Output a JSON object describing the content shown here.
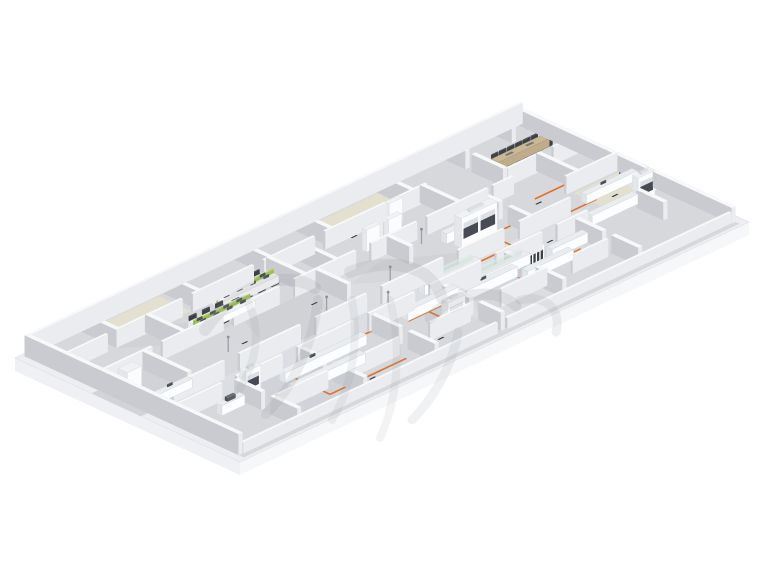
{
  "scene": {
    "kind": "isometric-3d-floorplan-render",
    "subject": "laboratory-and-office-floor",
    "background": "#ffffff",
    "watermark_present": true
  },
  "palette": {
    "slab_top": "#eceef1",
    "slab_edge": "#e0e2e6",
    "skirt_left": "#eff0f3",
    "skirt_front": "#f6f7f9",
    "floor": "#d7d8dc",
    "floor_light": "#dcdde1",
    "floor_dark": "#d1d3d8",
    "corridor": "#dddee3",
    "beige": "#e3e0d0",
    "wall_top": "#f7f8fa",
    "wall_light": "#eaecef",
    "wall_dark": "#c9cbd0",
    "furn_top": "#eaedef",
    "furn_light": "#fcfdfe",
    "furn_dark": "#e0e3e7",
    "accent_orange": "#e0702b",
    "partition_green": "#9dc14d",
    "partition_green_dark": "#86ab3b",
    "partition_green_top": "#b3d06a",
    "wood_top": "#c9b795",
    "wood_light": "#bfac8a",
    "wood_dark": "#ab997a",
    "chair_dark": "#33363b",
    "sash_dark": "#474c54",
    "glass_tint": "#b0c6bc",
    "screen_blue": "#8499ad",
    "mark_dark": "#2f3237",
    "watermark": "#8e9298"
  },
  "iso": {
    "origin": [
      15,
      358
    ],
    "e1": [
      5.09,
      -2.4
    ],
    "e2": [
      2.25,
      1.04
    ],
    "skirt_depth": 13,
    "floor_inset": 1.3
  },
  "floors": {
    "beige_patches": [
      [
        13,
        3,
        14,
        14
      ],
      [
        55,
        3,
        16,
        15
      ],
      [
        89,
        47,
        9,
        14
      ]
    ],
    "corridor": [
      2,
      56,
      84,
      10
    ],
    "tints": [
      [
        0,
        34,
        13,
        22,
        "floor_dark"
      ],
      [
        44,
        34,
        14,
        22,
        "floor_light"
      ],
      [
        13,
        66,
        13,
        30,
        "floor_dark"
      ],
      [
        53,
        66,
        13,
        31,
        "floor_light"
      ]
    ],
    "shade_sweeps": [
      [
        30,
        34,
        44,
        34,
        38,
        56,
        26,
        56
      ],
      [
        48,
        40,
        56,
        36,
        70,
        56,
        60,
        60
      ],
      [
        12,
        18,
        20,
        14,
        30,
        33,
        20,
        33
      ],
      [
        60,
        66,
        70,
        66,
        64,
        84,
        54,
        84
      ]
    ]
  },
  "walls": {
    "perimeter": [
      [
        1.3,
        1.3,
        97.4,
        1.1,
        21
      ],
      [
        1.3,
        2.4,
        0.8,
        94,
        21
      ],
      [
        97.9,
        2.4,
        0.8,
        56,
        16
      ],
      [
        97.9,
        62,
        0.8,
        35,
        16
      ],
      [
        2.1,
        95.6,
        50,
        1.1,
        11
      ],
      [
        54,
        95.6,
        44,
        1.1,
        11
      ]
    ],
    "interior": [
      [
        1.3,
        17,
        9,
        1,
        18
      ],
      [
        12,
        17,
        13,
        1,
        18
      ],
      [
        27,
        17,
        12,
        1,
        18
      ],
      [
        41,
        17,
        10,
        1,
        18
      ],
      [
        53,
        17,
        12,
        1,
        18
      ],
      [
        67,
        17,
        6,
        1,
        18
      ],
      [
        2,
        33,
        10,
        1,
        18
      ],
      [
        14,
        33,
        12,
        1,
        18
      ],
      [
        28,
        33,
        9,
        1,
        18
      ],
      [
        40,
        33,
        12,
        1,
        18
      ],
      [
        55,
        33,
        9,
        1,
        18
      ],
      [
        66,
        33,
        12,
        1,
        18
      ],
      [
        79,
        33,
        4,
        1,
        18
      ],
      [
        84,
        28,
        6,
        1,
        18
      ],
      [
        93,
        28,
        5,
        1,
        18
      ],
      [
        6,
        56,
        10,
        1,
        18
      ],
      [
        19,
        56,
        12,
        1,
        18
      ],
      [
        34,
        56,
        10,
        1,
        18
      ],
      [
        47,
        56,
        12,
        1,
        18
      ],
      [
        62,
        56,
        9,
        1,
        18
      ],
      [
        74,
        56,
        10,
        1,
        18
      ],
      [
        2.1,
        66,
        9,
        1,
        18
      ],
      [
        14,
        66,
        9,
        1,
        18
      ],
      [
        26,
        66,
        11,
        1,
        18
      ],
      [
        40,
        66,
        9,
        1,
        18
      ],
      [
        52,
        66,
        10,
        1,
        18
      ],
      [
        65,
        66,
        9,
        1,
        18
      ],
      [
        77,
        66,
        6,
        1,
        18
      ],
      [
        14,
        84,
        10,
        1,
        18
      ],
      [
        28,
        84,
        10,
        1,
        18
      ],
      [
        44,
        84,
        8,
        1,
        18
      ],
      [
        58,
        84,
        9,
        1,
        18
      ],
      [
        72,
        84,
        7,
        1,
        18
      ],
      [
        88,
        45,
        10,
        1,
        18
      ],
      [
        12,
        1.3,
        0.8,
        16,
        18
      ],
      [
        28,
        1.3,
        0.8,
        16,
        18
      ],
      [
        42,
        1.3,
        0.8,
        16,
        18
      ],
      [
        54,
        1.3,
        0.8,
        16,
        18
      ],
      [
        70,
        1.3,
        0.8,
        16,
        18
      ],
      [
        83.5,
        1.3,
        0.8,
        10,
        18
      ],
      [
        83.5,
        14,
        0.8,
        14,
        18
      ],
      [
        93.5,
        1.3,
        0.8,
        8,
        18
      ],
      [
        18,
        17,
        0.8,
        16,
        18
      ],
      [
        41.8,
        17,
        0.8,
        16,
        18
      ],
      [
        48,
        18,
        0.8,
        15,
        18
      ],
      [
        60,
        17,
        0.8,
        9,
        18
      ],
      [
        72,
        17,
        0.8,
        16,
        18
      ],
      [
        10,
        34,
        0.8,
        20,
        18
      ],
      [
        44,
        34,
        0.8,
        14,
        18
      ],
      [
        58,
        34,
        0.8,
        10,
        18
      ],
      [
        76,
        34,
        0.8,
        9,
        18
      ],
      [
        76,
        47,
        0.8,
        9,
        18
      ],
      [
        90,
        28,
        0.8,
        17,
        18
      ],
      [
        13,
        68,
        0.8,
        12,
        18
      ],
      [
        13,
        84,
        0.8,
        12,
        18
      ],
      [
        26,
        68,
        0.8,
        10,
        18
      ],
      [
        26,
        82,
        0.8,
        14,
        18
      ],
      [
        40,
        68,
        0.8,
        12,
        18
      ],
      [
        40,
        84,
        0.8,
        12,
        18
      ],
      [
        53,
        70,
        0.8,
        12,
        18
      ],
      [
        53,
        86,
        0.8,
        10,
        18
      ],
      [
        66,
        68,
        0.8,
        10,
        18
      ],
      [
        66,
        82,
        0.8,
        12,
        18
      ],
      [
        80,
        68,
        0.8,
        12,
        18
      ],
      [
        80,
        84,
        0.8,
        12,
        18
      ],
      [
        92,
        68,
        0.8,
        12,
        18
      ]
    ]
  },
  "furniture": {
    "desk_clusters": [
      {
        "s": 23,
        "t": 25,
        "desks_per_row": 4,
        "rows": 2,
        "chairs_per_side": 4
      },
      {
        "s": 30.5,
        "t": 18.4,
        "desks_per_row": 4,
        "rows": 2,
        "chairs_per_side": 4
      }
    ],
    "conference": {
      "table": [
        86.5,
        16,
        10,
        3.2,
        8
      ],
      "chairs_per_side": 6,
      "end_chairs": 2
    },
    "benches": [
      [
        21,
        70,
        16,
        2.6,
        10,
        "monitor"
      ],
      [
        19,
        78.5,
        14,
        2.6,
        10,
        ""
      ],
      [
        8,
        71.5,
        4.5,
        2.4,
        10,
        "instrument"
      ],
      [
        4.5,
        51.5,
        6.5,
        2.4,
        9,
        "monitor"
      ],
      [
        46,
        68,
        10,
        2.6,
        10,
        ""
      ],
      [
        56,
        71.5,
        10,
        2.6,
        10,
        "monitor"
      ],
      [
        66,
        76,
        9,
        2.6,
        10,
        ""
      ],
      [
        73,
        71,
        7,
        2.6,
        10,
        ""
      ],
      [
        53,
        59.5,
        11,
        2.7,
        10,
        "glass"
      ],
      [
        59,
        68,
        11,
        2.7,
        10,
        "glass"
      ],
      [
        66,
        40,
        10,
        2.6,
        10,
        ""
      ],
      [
        84,
        64,
        9,
        2.5,
        10,
        ""
      ],
      [
        88,
        52.5,
        10,
        2.4,
        9,
        "monitor"
      ],
      [
        95.6,
        54.9,
        2.3,
        9,
        9,
        ""
      ]
    ],
    "fume_hoods": [
      [
        66.5,
        44.8,
        7,
        3.2,
        30,
        2
      ],
      [
        29.5,
        69.5,
        3.4,
        2.7,
        26,
        1
      ],
      [
        48,
        81,
        3.4,
        2.8,
        27,
        1
      ],
      [
        14.2,
        67.8,
        3,
        2.6,
        25,
        1
      ],
      [
        93,
        64,
        3.3,
        2.6,
        26,
        1
      ],
      [
        3.2,
        38.5,
        2.8,
        4.2,
        22,
        0
      ]
    ],
    "tall_cabinets": [
      [
        56.5,
        26.5,
        2.6,
        2,
        22
      ],
      [
        60.8,
        26.5,
        2.6,
        2,
        22
      ],
      [
        63.8,
        20,
        2.6,
        2,
        24
      ]
    ],
    "gas_cabinets": [
      [
        68.5,
        71.5,
        3.2,
        1.5,
        17
      ]
    ],
    "safety_poles": [
      [
        22,
        45
      ],
      [
        40,
        48
      ],
      [
        52.5,
        48
      ],
      [
        63.5,
        37
      ],
      [
        47,
        59.5
      ]
    ],
    "ceiling_fixture": [
      96.3,
      51
    ],
    "wall_screen": [
      97.3,
      65.5
    ]
  },
  "utility_lines": {
    "color_key": "accent_orange",
    "paths": [
      [
        [
          23,
          69
        ],
        [
          23,
          88
        ],
        [
          38,
          88
        ]
      ],
      [
        [
          26,
          67.2
        ],
        [
          42,
          67.2
        ],
        [
          42,
          72
        ]
      ],
      [
        [
          33,
          67.2
        ],
        [
          33,
          63
        ]
      ],
      [
        [
          46,
          70.8
        ],
        [
          57,
          70.8
        ]
      ],
      [
        [
          50,
          66.4
        ],
        [
          50,
          76
        ]
      ],
      [
        [
          56,
          66.4
        ],
        [
          74,
          66.4
        ]
      ],
      [
        [
          62,
          66.4
        ],
        [
          62,
          59
        ]
      ],
      [
        [
          66,
          69.5
        ],
        [
          66,
          75
        ],
        [
          78,
          75
        ]
      ],
      [
        [
          72,
          66.4
        ],
        [
          72,
          78
        ],
        [
          80,
          78
        ]
      ],
      [
        [
          58,
          58.5
        ],
        [
          72,
          58.5
        ],
        [
          72,
          52
        ]
      ],
      [
        [
          66,
          48.3
        ],
        [
          84,
          48.3
        ]
      ],
      [
        [
          70,
          48.3
        ],
        [
          70,
          44
        ]
      ],
      [
        [
          80,
          48.3
        ],
        [
          80,
          55
        ],
        [
          90,
          55
        ]
      ],
      [
        [
          84,
          41
        ],
        [
          93,
          41
        ]
      ],
      [
        [
          2.5,
          40
        ],
        [
          2.5,
          48
        ]
      ]
    ]
  },
  "floor_marks": [
    [
      20,
      64.3
    ],
    [
      34,
      64.3
    ],
    [
      49,
      64.3
    ],
    [
      63,
      64.6
    ],
    [
      76,
      64.3
    ],
    [
      30,
      89.5
    ],
    [
      45,
      86
    ],
    [
      9,
      47
    ],
    [
      56.5,
      30.5
    ],
    [
      70,
      31
    ],
    [
      83,
      43.5
    ],
    [
      92,
      57
    ],
    [
      40,
      41
    ],
    [
      58,
      18
    ],
    [
      25,
      44
    ],
    [
      68,
      82
    ]
  ],
  "watermark": {
    "strokes": [
      [
        "M205,330 C235,285 285,268 315,288",
        12,
        0.16
      ],
      [
        "M318,300 C312,348 292,388 266,414",
        10,
        0.15
      ],
      [
        "M350,272 C392,256 432,266 442,298",
        12,
        0.16
      ],
      [
        "M352,300 C360,345 350,390 332,420",
        8,
        0.12
      ],
      [
        "M430,318 C452,292 496,286 516,306",
        11,
        0.16
      ],
      [
        "M458,332 C452,368 432,400 412,420",
        9,
        0.13
      ],
      [
        "M520,300 C546,294 562,310 556,332",
        9,
        0.14
      ],
      [
        "M248,302 C262,332 256,362 240,388",
        8,
        0.12
      ],
      [
        "M390,300 C402,348 398,398 380,438",
        8,
        0.11
      ]
    ]
  }
}
